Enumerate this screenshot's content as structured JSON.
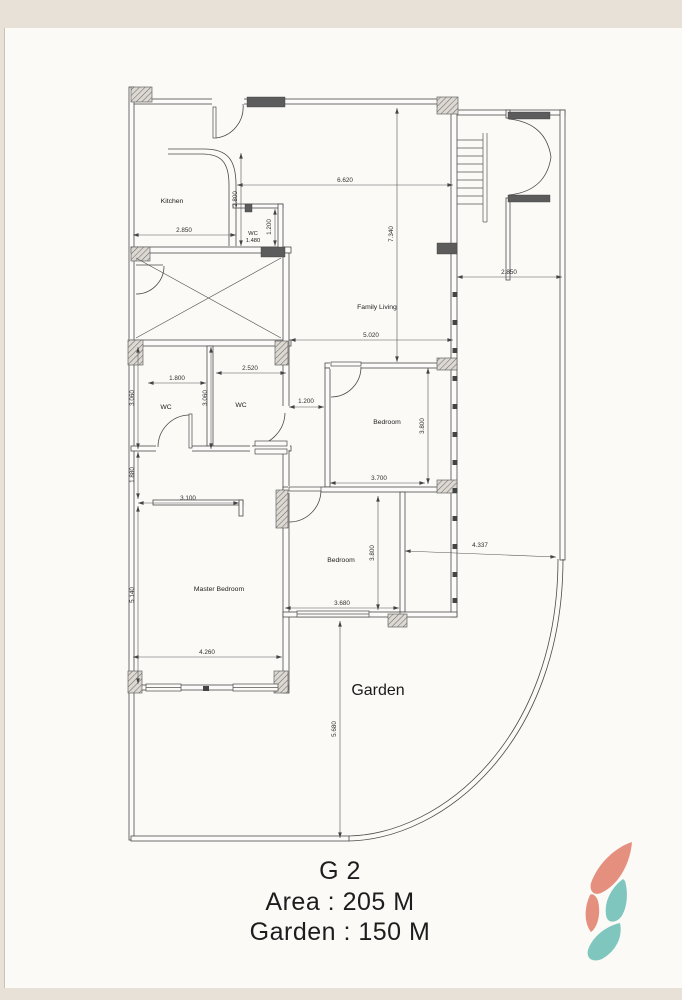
{
  "page": {
    "background": "#e7e1d8",
    "paper": "#fbfaf7"
  },
  "plan": {
    "rooms": {
      "kitchen": "Kitchen",
      "wc_small": "WC",
      "wc_left": "WC",
      "wc_right": "WC",
      "family_living": "Family Living",
      "bedroom_right": "Bedroom",
      "bedroom_middle": "Bedroom",
      "master_bedroom": "Master Bedroom",
      "garden": "Garden"
    },
    "dimensions": {
      "top_width": "6.620",
      "living_height": "7.340",
      "kitchen_width": "2.850",
      "kitchen_height": "2.800",
      "wc_small_width": "1.480",
      "wc_small_height": "1.200",
      "side_yard_width": "2.850",
      "living_width": "5.020",
      "wc_left_width": "1.800",
      "wc_left_height": "3.060",
      "wc_right_width": "2.520",
      "wc_mid_height": "3.060",
      "hall_opening": "1.200",
      "bedroom_right_width": "3.700",
      "bedroom_right_height": "3.800",
      "hall_height": "1.880",
      "hall_width": "3.100",
      "master_height": "5.140",
      "master_width": "4.260",
      "bedroom_middle_height": "3.800",
      "bedroom_middle_width": "3.680",
      "garden_width": "4.337",
      "garden_height": "5.680"
    }
  },
  "title": {
    "unit": "G 2",
    "area": "Area : 205 M",
    "garden": "Garden : 150 M"
  },
  "logo": {
    "coral": "#e5907f",
    "teal": "#7fc6bf"
  }
}
